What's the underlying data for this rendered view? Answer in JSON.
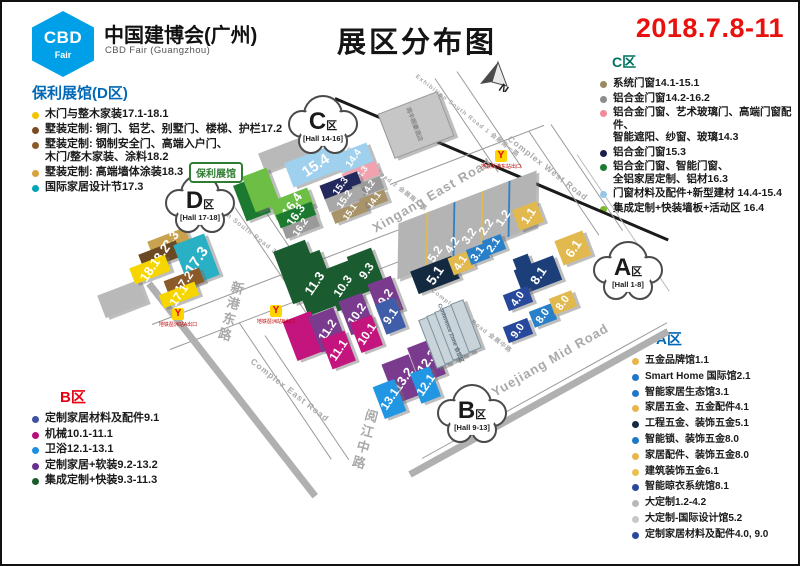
{
  "header": {
    "logo_line1": "CBD",
    "logo_line2": "Fair",
    "org_cn": "中国建博会(广州)",
    "org_en": "CBD Fair (Guangzhou)",
    "title": "展区分布图",
    "date": "2018.7.8-11",
    "date_color": "#e8110d",
    "logo_color": "#00a0e9"
  },
  "legends": {
    "d": {
      "title": "保利展馆(D区)",
      "color": "#0068b7",
      "items": [
        {
          "dot": "#f2c500",
          "lines": [
            "木门与整木家装17.1-18.1"
          ]
        },
        {
          "dot": "#7a4a21",
          "lines": [
            "墅装定制: 铜门、铝艺、别墅门、楼梯、护栏17.2"
          ]
        },
        {
          "dot": "#8a5a28",
          "lines": [
            "墅装定制: 钢制安全门、高端入户门、",
            "木门/整木家装、涂料18.2"
          ]
        },
        {
          "dot": "#d8a23c",
          "lines": [
            "墅装定制: 高端墙体涂装18.3"
          ]
        },
        {
          "dot": "#00a5b5",
          "lines": [
            "国际家居设计节17.3"
          ]
        }
      ]
    },
    "b": {
      "title": "B区",
      "color": "#e60012",
      "items": [
        {
          "dot": "#3f51a3",
          "lines": [
            "定制家居材料及配件9.1"
          ]
        },
        {
          "dot": "#b50f7d",
          "lines": [
            "机械10.1-11.1"
          ]
        },
        {
          "dot": "#1e8fe0",
          "lines": [
            "卫浴12.1-13.1"
          ]
        },
        {
          "dot": "#6a2d8f",
          "lines": [
            "定制家居+软装9.2-13.2"
          ]
        },
        {
          "dot": "#1a5c2a",
          "lines": [
            "集成定制+快装9.3-11.3"
          ]
        }
      ]
    },
    "c": {
      "title": "C区",
      "color": "#00715e",
      "items": [
        {
          "dot": "#9a8a62",
          "lines": [
            "系统门窗14.1-15.1"
          ]
        },
        {
          "dot": "#8c8c8c",
          "lines": [
            "铝合金门窗14.2-16.2"
          ]
        },
        {
          "dot": "#f08a9b",
          "lines": [
            "铝合金门窗、艺术玻璃门、高端门窗配件、",
            "智能遮阳、纱窗、玻璃14.3"
          ]
        },
        {
          "dot": "#1a1f4e",
          "lines": [
            "铝合金门窗15.3"
          ]
        },
        {
          "dot": "#1a7a2e",
          "lines": [
            "铝合金门窗、智能门窗、",
            "全铝家居定制、铝材16.3"
          ]
        },
        {
          "dot": "#8ec9f0",
          "lines": [
            "门窗材料及配件+新型建材 14.4-15.4"
          ]
        },
        {
          "dot": "#7ab928",
          "lines": [
            "集成定制+快装墙板+活动区 16.4"
          ]
        }
      ]
    },
    "a": {
      "title": "A区",
      "color": "#0068b7",
      "items": [
        {
          "dot": "#e8b64c",
          "lines": [
            "五金品牌馆1.1"
          ]
        },
        {
          "dot": "#1e78c8",
          "lines": [
            "Smart Home 国际馆2.1"
          ]
        },
        {
          "dot": "#1e78c8",
          "lines": [
            "智能家居生态馆3.1"
          ]
        },
        {
          "dot": "#e8b64c",
          "lines": [
            "家居五金、五金配件4.1"
          ]
        },
        {
          "dot": "#13293f",
          "lines": [
            "工程五金、装饰五金5.1"
          ]
        },
        {
          "dot": "#1e78c8",
          "lines": [
            "智能锁、装饰五金8.0"
          ]
        },
        {
          "dot": "#e8b64c",
          "lines": [
            "家居配件、装饰五金8.0"
          ]
        },
        {
          "dot": "#e8c050",
          "lines": [
            "建筑装饰五金6.1"
          ]
        },
        {
          "dot": "#27489b",
          "lines": [
            "智能晾衣系统馆8.1"
          ]
        },
        {
          "dot": "#b8b8b8",
          "lines": [
            "大定制1.2-4.2"
          ]
        },
        {
          "dot": "#c8c8c8",
          "lines": [
            "大定制-国际设计馆5.2"
          ]
        },
        {
          "dot": "#27489b",
          "lines": [
            "定制家居材料及配件4.0, 9.0"
          ]
        }
      ]
    }
  },
  "map": {
    "poly_tag": "保利展馆",
    "compass_letter": "N",
    "clouds": [
      {
        "letter": "C",
        "suffix": "区",
        "range": "[Hall 14-16]",
        "x": 321,
        "y": 125
      },
      {
        "letter": "D",
        "suffix": "区",
        "range": "[Hall 17-18]",
        "x": 198,
        "y": 204
      },
      {
        "letter": "A",
        "suffix": "区",
        "range": "[Hall 1-8]",
        "x": 626,
        "y": 271
      },
      {
        "letter": "B",
        "suffix": "区",
        "range": "[Hall 9-13]",
        "x": 470,
        "y": 414
      }
    ],
    "metro": [
      {
        "x": 493,
        "y": 148,
        "label": "地铁新港东站出口"
      },
      {
        "x": 170,
        "y": 306,
        "label": "地铁琶洲站A出口"
      },
      {
        "x": 268,
        "y": 303,
        "label": "地铁琶洲站B出口"
      }
    ],
    "road_labels": [
      {
        "t": "Xingang East Road",
        "x": 430,
        "y": 193,
        "r": -30,
        "fs": 13
      },
      {
        "t": "Yuejiang Mid Road",
        "x": 548,
        "y": 358,
        "r": -30,
        "fs": 13
      },
      {
        "t": "Complex West Road",
        "x": 546,
        "y": 166,
        "r": 38,
        "fs": 8.5
      },
      {
        "t": "Complex East Road",
        "x": 288,
        "y": 388,
        "r": 38,
        "fs": 8.5
      },
      {
        "t": "Complex Mid Road 会展中路",
        "x": 470,
        "y": 318,
        "r": 38,
        "fs": 6
      },
      {
        "t": "Exhibition South Road 1 会展南一路",
        "x": 466,
        "y": 113,
        "r": 38,
        "fs": 6
      },
      {
        "t": "Exhibition South Road 2 会展南二路",
        "x": 374,
        "y": 167,
        "r": 38,
        "fs": 6
      },
      {
        "t": "Exhibition South Road 3 会展南三路",
        "x": 252,
        "y": 232,
        "r": 38,
        "fs": 6.5
      },
      {
        "t": "新港东路",
        "x": 228,
        "y": 310,
        "r": 15,
        "fs": 13,
        "vert": true
      },
      {
        "t": "阅江中路",
        "x": 362,
        "y": 438,
        "r": 15,
        "fs": 13,
        "vert": true
      }
    ],
    "lines": [
      {
        "x": 333,
        "y": 96,
        "r": 23,
        "l": 362,
        "t": 3,
        "c": "#1a1a1a"
      },
      {
        "x": 306,
        "y": 130,
        "r": 38,
        "l": 46,
        "t": 3,
        "c": "#1a1a1a"
      },
      {
        "x": 150,
        "y": 322,
        "r": -21,
        "l": 265,
        "t": 1,
        "c": "#9a9a9a"
      },
      {
        "x": 168,
        "y": 347,
        "r": -21,
        "l": 280,
        "t": 1,
        "c": "#9a9a9a"
      },
      {
        "x": 388,
        "y": 182,
        "r": -21,
        "l": 165,
        "t": 1,
        "c": "#9a9a9a"
      },
      {
        "x": 527,
        "y": 129,
        "r": 56,
        "l": 125,
        "t": 1,
        "c": "#9a9a9a"
      },
      {
        "x": 549,
        "y": 122,
        "r": 56,
        "l": 128,
        "t": 1,
        "c": "#9a9a9a"
      },
      {
        "x": 237,
        "y": 320,
        "r": 56,
        "l": 165,
        "t": 1,
        "c": "#9a9a9a"
      },
      {
        "x": 263,
        "y": 333,
        "r": 56,
        "l": 150,
        "t": 1,
        "c": "#9a9a9a"
      },
      {
        "x": 233,
        "y": 205,
        "r": 56,
        "l": 128,
        "t": 1,
        "c": "#9a9a9a"
      },
      {
        "x": 256,
        "y": 198,
        "r": 56,
        "l": 133,
        "t": 1,
        "c": "#9a9a9a"
      },
      {
        "x": 433,
        "y": 76,
        "r": 56,
        "l": 113,
        "t": 1,
        "c": "#9a9a9a"
      },
      {
        "x": 455,
        "y": 69,
        "r": 56,
        "l": 116,
        "t": 1,
        "c": "#9a9a9a"
      },
      {
        "x": 575,
        "y": 152,
        "r": 56,
        "l": 165,
        "t": 1,
        "c": "#bbbbbb"
      },
      {
        "x": 420,
        "y": 456,
        "r": -29,
        "l": 280,
        "t": 1,
        "c": "#9a9a9a"
      },
      {
        "x": 408,
        "y": 472,
        "r": -29,
        "l": 295,
        "t": 7,
        "c": "#b0b0b0"
      },
      {
        "x": 147,
        "y": 281,
        "r": 52,
        "l": 270,
        "t": 7,
        "c": "#b0b0b0"
      }
    ],
    "halls": [
      {
        "id": "",
        "c": "#b9b9b9",
        "cx": 283,
        "cy": 152,
        "w": 50,
        "h": 20,
        "rot": -21
      },
      {
        "id": "",
        "c": "#c6c6c6",
        "cx": 413,
        "cy": 122,
        "w": 62,
        "h": 46,
        "rot": -21,
        "bd": "#9a9a9a"
      },
      {
        "id": "15.4",
        "c": "#9fd0ee",
        "cx": 314,
        "cy": 163,
        "w": 58,
        "h": 26,
        "rot": -21,
        "fs": 15,
        "lr": -13
      },
      {
        "id": "14.4",
        "c": "#9fd0ee",
        "cx": 352,
        "cy": 156,
        "w": 34,
        "h": 20,
        "rot": -21,
        "fs": 10
      },
      {
        "id": "14.3",
        "c": "#f2a2af",
        "cx": 359,
        "cy": 172,
        "w": 36,
        "h": 14,
        "rot": -21,
        "fs": 9
      },
      {
        "id": "15.3",
        "c": "#23295c",
        "cx": 339,
        "cy": 184,
        "w": 40,
        "h": 16,
        "rot": -21,
        "fs": 10
      },
      {
        "id": "14.2",
        "c": "#9a9a9a",
        "cx": 366,
        "cy": 185,
        "w": 30,
        "h": 13,
        "rot": -21,
        "fs": 9
      },
      {
        "id": "15.2",
        "c": "#a8a8a8",
        "cx": 343,
        "cy": 197,
        "w": 38,
        "h": 14,
        "rot": -21,
        "fs": 10
      },
      {
        "id": "14.1",
        "c": "#a89468",
        "cx": 371,
        "cy": 198,
        "w": 27,
        "h": 12,
        "rot": -21,
        "fs": 9
      },
      {
        "id": "15.1",
        "c": "#a89468",
        "cx": 347,
        "cy": 210,
        "w": 35,
        "h": 12,
        "rot": -21,
        "fs": 9
      },
      {
        "id": "",
        "c": "#1c7a30",
        "cx": 250,
        "cy": 197,
        "w": 26,
        "h": 38,
        "rot": -21
      },
      {
        "id": "",
        "c": "#6cbe45",
        "cx": 259,
        "cy": 188,
        "w": 26,
        "h": 38,
        "rot": -21
      },
      {
        "id": "16.4",
        "c": "#6cbe45",
        "cx": 290,
        "cy": 202,
        "w": 40,
        "h": 20,
        "rot": -21,
        "fs": 13
      },
      {
        "id": "16.3",
        "c": "#1c7a30",
        "cx": 294,
        "cy": 213,
        "w": 38,
        "h": 14,
        "rot": -21,
        "fs": 12
      },
      {
        "id": "16.2",
        "c": "#9a9a9a",
        "cx": 299,
        "cy": 225,
        "w": 36,
        "h": 12,
        "rot": -21,
        "fs": 10
      },
      {
        "id": "",
        "c": "#b9b9b9",
        "cx": 120,
        "cy": 297,
        "w": 44,
        "h": 24,
        "rot": -21
      },
      {
        "id": "18.3",
        "c": "#c8a24e",
        "cx": 167,
        "cy": 240,
        "w": 40,
        "h": 17,
        "rot": -21,
        "fs": 13
      },
      {
        "id": "18.2",
        "c": "#6b4a23",
        "cx": 158,
        "cy": 253,
        "w": 40,
        "h": 17,
        "rot": -21,
        "fs": 13
      },
      {
        "id": "17.3",
        "c": "#2ab0c5",
        "cx": 194,
        "cy": 258,
        "w": 33,
        "h": 44,
        "rot": -21,
        "fs": 15
      },
      {
        "id": "18.1",
        "c": "#f7d600",
        "cx": 148,
        "cy": 267,
        "w": 38,
        "h": 17,
        "rot": -21,
        "fs": 13
      },
      {
        "id": "17.2",
        "c": "#8a5a28",
        "cx": 182,
        "cy": 279,
        "w": 38,
        "h": 15,
        "rot": -21,
        "fs": 12
      },
      {
        "id": "17.1",
        "c": "#f7d600",
        "cx": 177,
        "cy": 293,
        "w": 38,
        "h": 14,
        "rot": -21,
        "fs": 12
      },
      {
        "id": "",
        "c": "#1a5c30",
        "cx": 297,
        "cy": 270,
        "w": 34,
        "h": 56,
        "rot": -21
      },
      {
        "id": "11.3",
        "c": "#1a5c30",
        "cx": 312,
        "cy": 281,
        "w": 34,
        "h": 58,
        "rot": -21,
        "fs": 13
      },
      {
        "id": "10.3",
        "c": "#1a5c30",
        "cx": 341,
        "cy": 284,
        "w": 28,
        "h": 44,
        "rot": -21,
        "fs": 12
      },
      {
        "id": "9.3",
        "c": "#1a5c30",
        "cx": 364,
        "cy": 269,
        "w": 26,
        "h": 40,
        "rot": -21,
        "fs": 12
      },
      {
        "id": "",
        "c": "#c4147d",
        "cx": 302,
        "cy": 334,
        "w": 30,
        "h": 42,
        "rot": -21
      },
      {
        "id": "11.2",
        "c": "#7a3b8f",
        "cx": 325,
        "cy": 328,
        "w": 27,
        "h": 38,
        "rot": -21,
        "fs": 12
      },
      {
        "id": "10.2",
        "c": "#7a3b8f",
        "cx": 354,
        "cy": 312,
        "w": 25,
        "h": 36,
        "rot": -21,
        "fs": 12
      },
      {
        "id": "9.2",
        "c": "#7a3b8f",
        "cx": 383,
        "cy": 295,
        "w": 25,
        "h": 36,
        "rot": -21,
        "fs": 12
      },
      {
        "id": "11.1",
        "c": "#c4147d",
        "cx": 336,
        "cy": 348,
        "w": 25,
        "h": 32,
        "rot": -21,
        "fs": 12
      },
      {
        "id": "10.1",
        "c": "#c4147d",
        "cx": 364,
        "cy": 332,
        "w": 23,
        "h": 32,
        "rot": -21,
        "fs": 12
      },
      {
        "id": "9.1",
        "c": "#3f5da8",
        "cx": 388,
        "cy": 314,
        "w": 21,
        "h": 32,
        "rot": -21,
        "fs": 12
      },
      {
        "id": "13.2",
        "c": "#7a3b8f",
        "cx": 400,
        "cy": 377,
        "w": 29,
        "h": 42,
        "rot": -21,
        "fs": 13
      },
      {
        "id": "12.2",
        "c": "#7a3b8f",
        "cx": 424,
        "cy": 359,
        "w": 27,
        "h": 38,
        "rot": -21,
        "fs": 13
      },
      {
        "id": "13.1",
        "c": "#2196e3",
        "cx": 387,
        "cy": 397,
        "w": 23,
        "h": 34,
        "rot": -21,
        "fs": 12
      },
      {
        "id": "12.1",
        "c": "#2196e3",
        "cx": 423,
        "cy": 383,
        "w": 21,
        "h": 32,
        "rot": -21,
        "fs": 12
      },
      {
        "id": "",
        "c": "#c9d4da",
        "cx": 431,
        "cy": 339,
        "w": 12,
        "h": 50,
        "rot": -21,
        "bd": "#7e929e"
      },
      {
        "id": "",
        "c": "#c9d4da",
        "cx": 439,
        "cy": 335,
        "w": 12,
        "h": 50,
        "rot": -21,
        "bd": "#7e929e"
      },
      {
        "id": "",
        "c": "#c9d4da",
        "cx": 447,
        "cy": 331,
        "w": 12,
        "h": 50,
        "rot": -21,
        "bd": "#7e929e"
      },
      {
        "id": "",
        "c": "#c9d4da",
        "cx": 455,
        "cy": 327,
        "w": 12,
        "h": 50,
        "rot": -21,
        "bd": "#7e929e"
      },
      {
        "id": "",
        "c": "#c9d4da",
        "cx": 463,
        "cy": 323,
        "w": 12,
        "h": 50,
        "rot": -21,
        "bd": "#7e929e"
      },
      {
        "id": "",
        "c": "#b4b4b4",
        "cx": 465,
        "cy": 223,
        "w": 148,
        "h": 52,
        "rot": -21,
        "skew": -22,
        "seams": [
          "#e2b94e",
          "#2980c9",
          "#e2b94e",
          "#2980c9"
        ]
      },
      {
        "id": "5.1",
        "c": "#13293f",
        "cx": 433,
        "cy": 273,
        "w": 44,
        "h": 24,
        "rot": -21,
        "fs": 14
      },
      {
        "id": "4.1",
        "c": "#e2b94e",
        "cx": 459,
        "cy": 261,
        "w": 22,
        "h": 18,
        "rot": -21,
        "fs": 11
      },
      {
        "id": "3.1",
        "c": "#2980c9",
        "cx": 476,
        "cy": 252,
        "w": 20,
        "h": 16,
        "rot": -21,
        "fs": 11
      },
      {
        "id": "2.1",
        "c": "#2980c9",
        "cx": 492,
        "cy": 243,
        "w": 20,
        "h": 16,
        "rot": -21,
        "fs": 11
      },
      {
        "id": "1.1",
        "c": "#e2b94e",
        "cx": 526,
        "cy": 214,
        "w": 26,
        "h": 22,
        "rot": -21,
        "fs": 12
      },
      {
        "id": "6.1",
        "c": "#e2b94e",
        "cx": 571,
        "cy": 246,
        "w": 30,
        "h": 26,
        "rot": -21,
        "fs": 13
      },
      {
        "id": "",
        "c": "#1c3f7a",
        "cx": 521,
        "cy": 262,
        "w": 16,
        "h": 16,
        "rot": -21
      },
      {
        "id": "8.1",
        "c": "#1c3f7a",
        "cx": 536,
        "cy": 273,
        "w": 42,
        "h": 26,
        "rot": -21,
        "fs": 13
      },
      {
        "id": "4.0",
        "c": "#27489b",
        "cx": 516,
        "cy": 296,
        "w": 26,
        "h": 17,
        "rot": -21,
        "fs": 11
      },
      {
        "id": "9.0",
        "c": "#27489b",
        "cx": 516,
        "cy": 328,
        "w": 26,
        "h": 17,
        "rot": -21,
        "fs": 11
      },
      {
        "id": "8.0",
        "c": "#2980c9",
        "cx": 541,
        "cy": 313,
        "w": 24,
        "h": 17,
        "rot": -21,
        "fs": 11
      },
      {
        "id": "8.0",
        "c": "#e2b94e",
        "cx": 561,
        "cy": 300,
        "w": 24,
        "h": 17,
        "rot": -21,
        "fs": 11
      }
    ],
    "float_labels": [
      {
        "t": "5.2",
        "x": 433,
        "y": 252,
        "r": -56,
        "fs": 12,
        "c": "#ffffff"
      },
      {
        "t": "4.2",
        "x": 450,
        "y": 243,
        "r": -56,
        "fs": 12,
        "c": "#ffffff"
      },
      {
        "t": "3.2",
        "x": 467,
        "y": 234,
        "r": -56,
        "fs": 12,
        "c": "#ffffff"
      },
      {
        "t": "2.2",
        "x": 484,
        "y": 225,
        "r": -56,
        "fs": 12,
        "c": "#ffffff"
      },
      {
        "t": "1.2",
        "x": 501,
        "y": 216,
        "r": -56,
        "fs": 12,
        "c": "#ffffff"
      },
      {
        "t": "南丰朗豪酒店",
        "x": 413,
        "y": 122,
        "r": 69,
        "fs": 6,
        "c": "#8a8a8a"
      },
      {
        "t": "Conference Zone 会议区",
        "x": 449,
        "y": 331,
        "r": 69,
        "fs": 5.5,
        "c": "#5a6b78"
      }
    ]
  }
}
